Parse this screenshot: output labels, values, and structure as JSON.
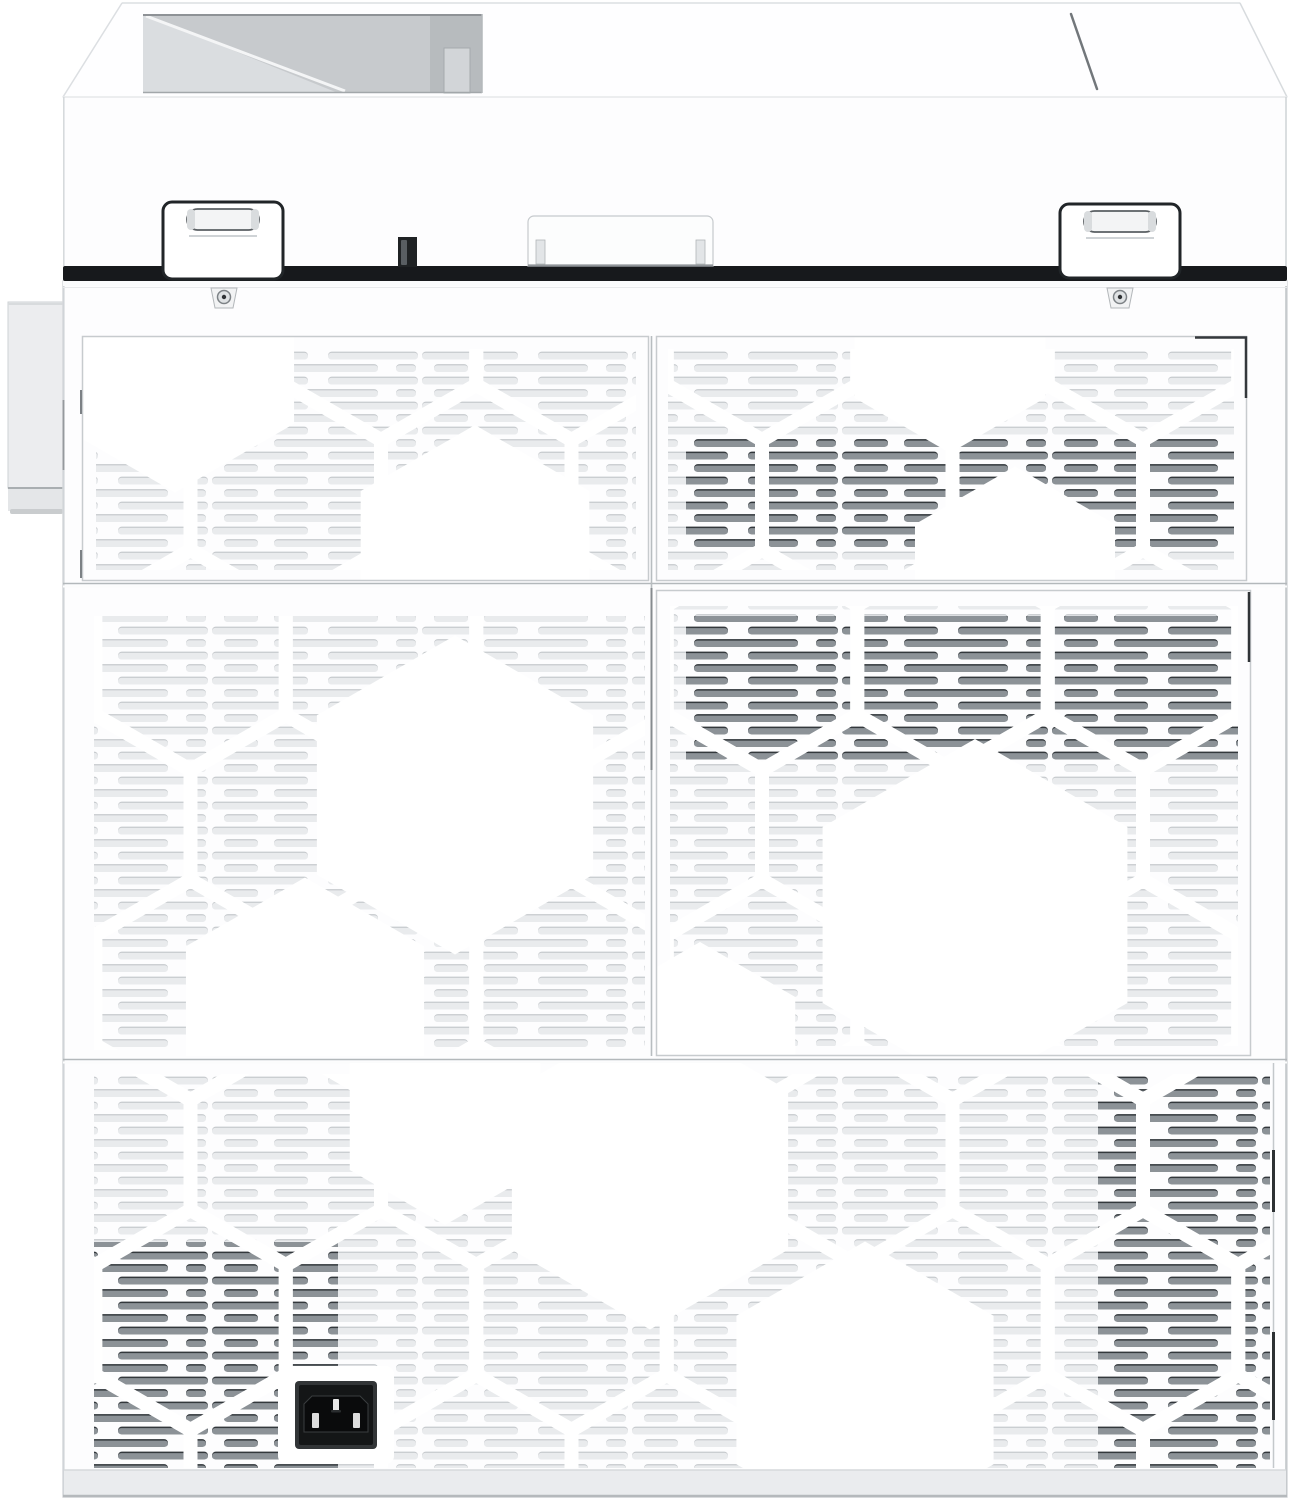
{
  "scene": {
    "description": "Rear-view product photograph of a white multifunction laser printer on a plain white background",
    "device_type": "multifunction laser printer",
    "view": "rear",
    "visible_text": "none"
  },
  "palette": {
    "bg": "#ffffff",
    "body_white": "#fdfdfe",
    "panel_line": "#c7cbce",
    "seam_gray": "#b3b8bb",
    "vent_light": "#e9ebed",
    "vent_light_shadow": "#c6cacd",
    "vent_dark": "#8c9297",
    "vent_dark_shadow": "#33383c",
    "gap_dark": "#17191c",
    "hinge_outline": "#212528",
    "recess_gray": "#c7cacd",
    "recess_slope": "#dadde0",
    "socket_black": "#141617",
    "socket_rim": "#323537",
    "pin_white": "#e8e8e8",
    "base_strip": "#eaecee"
  },
  "components": {
    "photo": {
      "label": "printer rear view photo"
    },
    "top_cover": {
      "label": "scanner lid / top cover"
    },
    "output_recess": {
      "label": "output tray recess"
    },
    "slash_mark": {
      "label": "seam mark on top cover"
    },
    "left_hinge": {
      "label": "left lid hinge"
    },
    "right_hinge": {
      "label": "right lid hinge"
    },
    "adf_handle": {
      "label": "rear cover handle tab"
    },
    "lock_slot": {
      "label": "cable lock slot"
    },
    "left_screw": {
      "label": "left cover screw"
    },
    "right_screw": {
      "label": "right cover screw"
    },
    "upper_left_vent": {
      "label": "upper left ventilation panel"
    },
    "upper_right_vent": {
      "label": "upper right ventilation panel"
    },
    "mid_left_vent": {
      "label": "middle left ventilation grille"
    },
    "rear_door": {
      "label": "rear access door with ventilation grille"
    },
    "lower_vent": {
      "label": "lower rear ventilation panel"
    },
    "side_tray": {
      "label": "left side tray protrusion"
    },
    "power_inlet": {
      "label": "AC power inlet IEC C14"
    },
    "base": {
      "label": "base strip"
    }
  }
}
